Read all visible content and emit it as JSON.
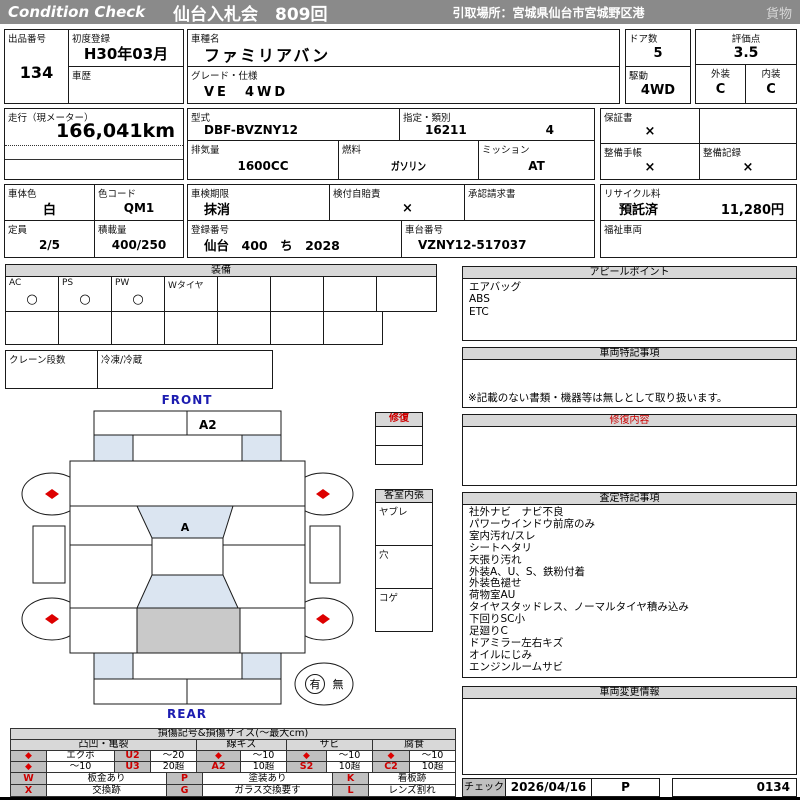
{
  "header": {
    "brand": "Condition  Check",
    "auction": "仙台入札会　809回",
    "pickup": "引取場所：宮城県仙台市宮城野区港",
    "category": "貨物"
  },
  "top": {
    "lot_label": "出品番号",
    "lot_value": "134",
    "first_reg_label": "初度登録",
    "first_reg_value": "H30年03月",
    "history_label": "車歴",
    "history_value": "",
    "model_name_label": "車種名",
    "model_name_value": "ファミリアバン",
    "grade_label": "グレード・仕様",
    "grade_value": "VE　4WD",
    "doors_label": "ドア数",
    "doors_value": "5",
    "drive_label": "駆動",
    "drive_value": "4WD",
    "score_label": "評価点",
    "score_value": "3.5",
    "exterior_label": "外装",
    "exterior_value": "C",
    "interior_label": "内装",
    "interior_value": "C"
  },
  "spec": {
    "mileage_label": "走行（現メーター）",
    "mileage_value": "166,041km",
    "model_code_label": "型式",
    "model_code_value": "DBF-BVZNY12",
    "type_label": "指定・類別",
    "type_value1": "16211",
    "type_value2": "4",
    "displacement_label": "排気量",
    "displacement_value": "1600CC",
    "fuel_label": "燃料",
    "fuel_value": "ガソリン",
    "mission_label": "ミッション",
    "mission_value": "AT",
    "warranty_label": "保証書",
    "warranty_value": "×",
    "book_label": "整備手帳",
    "book_value": "×",
    "record_label": "整備記録",
    "record_value": "×"
  },
  "reg": {
    "body_color_label": "車体色",
    "body_color_value": "白",
    "color_code_label": "色コード",
    "color_code_value": "QM1",
    "capacity_label": "定員",
    "capacity_value": "2/5",
    "load_label": "積載量",
    "load_value": "400/250",
    "inspection_label": "車検期限",
    "inspection_value": "抹消",
    "insurance_label": "検付自賠責",
    "insurance_value": "×",
    "approval_label": "承認請求書",
    "approval_value": "",
    "reg_no_label": "登録番号",
    "reg_no_value": "仙台　400　ち　2028",
    "chassis_label": "車台番号",
    "chassis_value": "VZNY12-517037",
    "recycle_label": "リサイクル料",
    "recycle_status": "預託済",
    "recycle_fee": "11,280円",
    "welfare_label": "福祉車両",
    "welfare_value": ""
  },
  "equipment": {
    "title": "装備",
    "cells": [
      {
        "label": "AC",
        "mark": "○"
      },
      {
        "label": "PS",
        "mark": "○"
      },
      {
        "label": "PW",
        "mark": "○"
      },
      {
        "label": "Wタイヤ",
        "mark": ""
      }
    ],
    "crane_label": "クレーン段数",
    "fridge_label": "冷凍/冷蔵"
  },
  "diagram": {
    "front": "FRONT",
    "rear": "REAR",
    "roof_code": "A2",
    "glass_code": "A",
    "spare_yes": "有",
    "spare_no": "無",
    "repair_title": "修復",
    "cabin_title": "客室内張",
    "cabin_rows": [
      "ヤブレ",
      "穴",
      "コゲ"
    ]
  },
  "appeal": {
    "title": "アピールポイント",
    "items": [
      "エアバッグ",
      "ABS",
      "ETC"
    ]
  },
  "vehicle_notes": {
    "title": "車両特記事項",
    "note": "※記載のない書類・機器等は無しとして取り扱います。"
  },
  "repair_details": {
    "title": "修復内容",
    "content": ""
  },
  "assessment": {
    "title": "査定特記事項",
    "items": [
      "社外ナビ　ナビ不良",
      "パワーウインドウ前席のみ",
      "室内汚れ/スレ",
      "シートヘタリ",
      "天張り汚れ",
      "外装A、U、S、鉄粉付着",
      "外装色褪せ",
      "荷物室AU",
      "タイヤスタッドレス、ノーマルタイヤ積み込み",
      "下回りSC小",
      "足廻りC",
      "ドアミラー左右キズ",
      "オイルにじみ",
      "エンジンルームサビ"
    ]
  },
  "change_info": {
    "title": "車両変更情報",
    "content": ""
  },
  "check": {
    "label": "チェック",
    "date": "2026/04/16",
    "inspector": "P",
    "number": "0134"
  },
  "legend": {
    "title": "損傷記号&損傷サイズ(～最大cm)",
    "categories": [
      "凸凹・亀裂",
      "線キズ",
      "サビ",
      "腐食"
    ],
    "row1": [
      "◆",
      "エクボ",
      "U2",
      "～20",
      "◆",
      "～10",
      "◆",
      "～10",
      "◆",
      "～10"
    ],
    "row2": [
      "◆",
      "～10",
      "U3",
      "20超",
      "A2",
      "10超",
      "S2",
      "10超",
      "C2",
      "10超"
    ],
    "codes_rows": [
      [
        "W",
        "板金あり",
        "P",
        "塗装あり",
        "K",
        "看板跡"
      ],
      [
        "X",
        "交換跡",
        "G",
        "ガラス交換要す",
        "L",
        "レンズ割れ"
      ]
    ]
  },
  "colors": {
    "header_bg": "#8a8a8a",
    "title_bar_bg": "#d8d8d8",
    "legend_gray": "#c0c0c0",
    "accent_red": "#cc0000",
    "front_rear_blue": "#1c1cb0",
    "glass_blue": "#dbe5f1",
    "cargo_gray": "#c9c9c9"
  }
}
